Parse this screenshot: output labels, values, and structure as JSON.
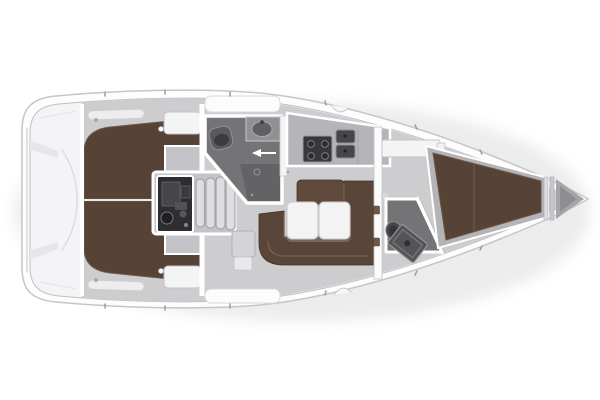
{
  "meta": {
    "description": "Top-down interior layout plan of a sailing yacht (floor plan, bow pointing right)"
  },
  "palette": {
    "background": "#ffffff",
    "hull": "#fdfdfe",
    "deck": "#f4f4f6",
    "sole": "#cdcdd0",
    "soleDark": "#c4c4c8",
    "berth": "#564336",
    "sofa": "#5a4638",
    "backrest": "#5f4a3c",
    "table": "#f3f3f4",
    "headFloor": "#747477",
    "headFloorDark": "#636366",
    "fixture": "#4a4a4d",
    "counter": "#b5b5b9",
    "stove": "#38383a",
    "sink": "#46464a",
    "engine": "#2e2d2f",
    "steps": "#dedee0",
    "cabinet": "#f4f4f5",
    "locker": "#a6a6aa",
    "outline": "#c6c6ca",
    "wall": "#ffffff"
  },
  "areas": [
    {
      "id": "transom",
      "label": "Transom / swim platform"
    },
    {
      "id": "aft-cabin-port",
      "label": "Aft double cabin (port)"
    },
    {
      "id": "aft-cabin-stbd",
      "label": "Aft double cabin (starboard)"
    },
    {
      "id": "engine",
      "label": "Engine compartment"
    },
    {
      "id": "companionway",
      "label": "Companionway steps"
    },
    {
      "id": "aft-head",
      "label": "Aft head with shower, toilet and sink"
    },
    {
      "id": "galley",
      "label": "Galley with stove and double sink"
    },
    {
      "id": "saloon",
      "label": "Saloon with U-shaped sofa and folding table"
    },
    {
      "id": "fwd-head",
      "label": "Forward head with toilet and vanity"
    },
    {
      "id": "fwd-cabin",
      "label": "Forward cabin with V-berth"
    },
    {
      "id": "anchor-locker",
      "label": "Anchor locker"
    },
    {
      "id": "deck",
      "label": "Side decks and hull"
    }
  ]
}
